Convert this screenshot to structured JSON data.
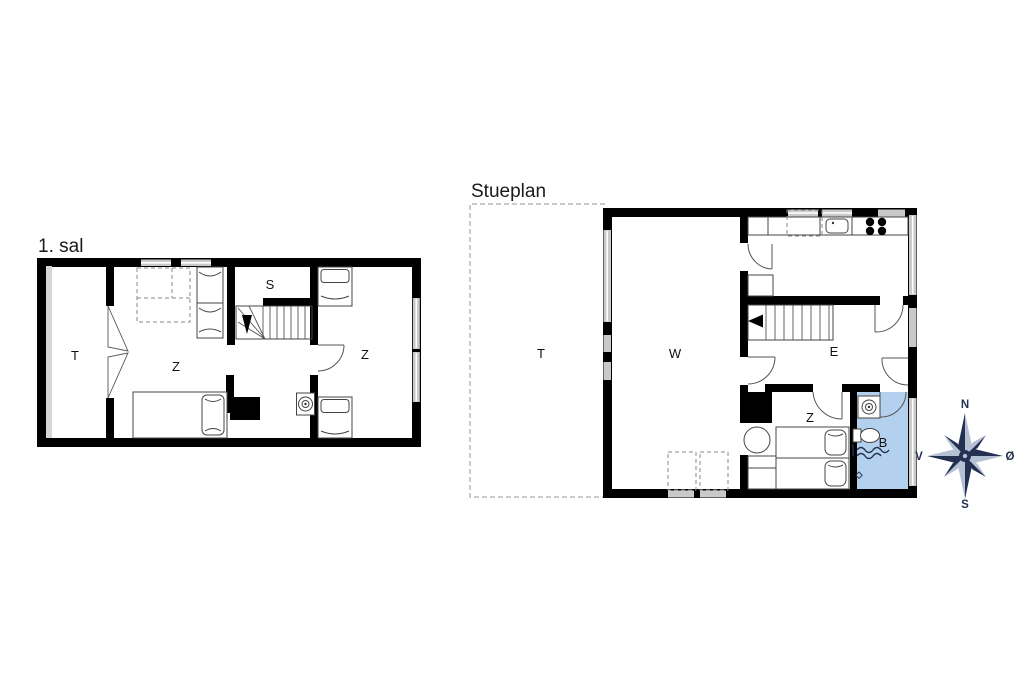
{
  "first_floor": {
    "title": "1. sal",
    "rooms": [
      {
        "id": "room-t",
        "label": "T"
      },
      {
        "id": "room-z-middle",
        "label": "Z"
      },
      {
        "id": "room-s",
        "label": "S"
      },
      {
        "id": "room-z-right",
        "label": "Z"
      }
    ]
  },
  "ground_floor": {
    "title": "Stueplan",
    "rooms": [
      {
        "id": "room-t",
        "label": "T"
      },
      {
        "id": "room-w",
        "label": "W"
      },
      {
        "id": "room-e",
        "label": "E"
      },
      {
        "id": "room-z",
        "label": "Z"
      },
      {
        "id": "room-b",
        "label": "B"
      }
    ]
  },
  "compass": {
    "north": "N",
    "south": "S",
    "west": "V",
    "east": "Ø"
  },
  "colors": {
    "wall": "#000000",
    "thin_line": "#444444",
    "window_fill": "#c9c9c9",
    "window_band_gray": "#d6d6d6",
    "bathroom_fill": "#b3d0ef",
    "compass_navy": "#233052",
    "compass_light": "#b6c0d4",
    "dash_gray": "#999999",
    "shower_line": "#22304a"
  }
}
